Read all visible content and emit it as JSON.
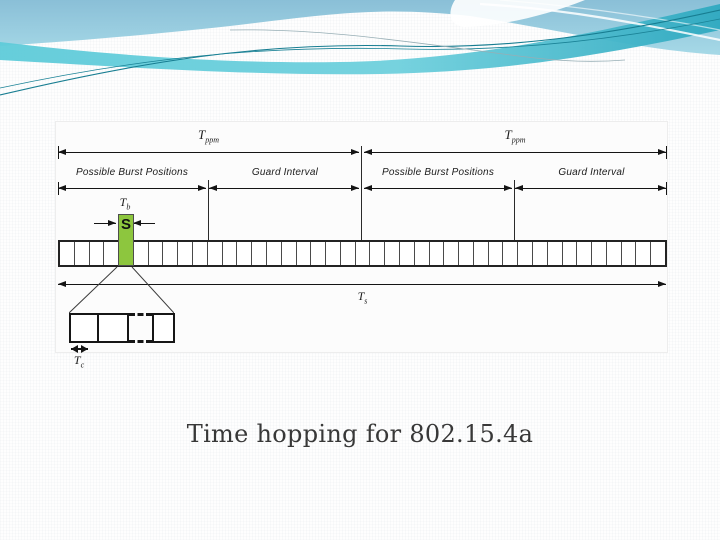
{
  "theme": {
    "header_sky_top": "#8abfd7",
    "header_sky_bottom": "#a6d9e7",
    "header_ribbon_light": "#5ecbd9",
    "header_ribbon_dark": "#2fa9c0",
    "header_curve_line": "#177d91",
    "slide_background": "#fefefe",
    "caption_color": "#383838",
    "diagram_line": "#141414",
    "burst_green": "#8dc63e"
  },
  "caption": "Time hopping for 802.15.4a",
  "diagram": {
    "labels": {
      "t_ppm": {
        "base": "T",
        "sub": "ppm"
      },
      "possible_burst_positions": "Possible Burst Positions",
      "guard_interval": "Guard Interval",
      "t_b": {
        "base": "T",
        "sub": "b"
      },
      "t_s": {
        "base": "T",
        "sub": "s"
      },
      "t_c": {
        "base": "T",
        "sub": "c"
      },
      "burst_symbol": "S"
    },
    "strip": {
      "cells": 41,
      "burst_cell": 5
    },
    "detail": {
      "solid_cells_left": 2,
      "solid_cells_right": 1,
      "continuation": "dashed"
    }
  }
}
